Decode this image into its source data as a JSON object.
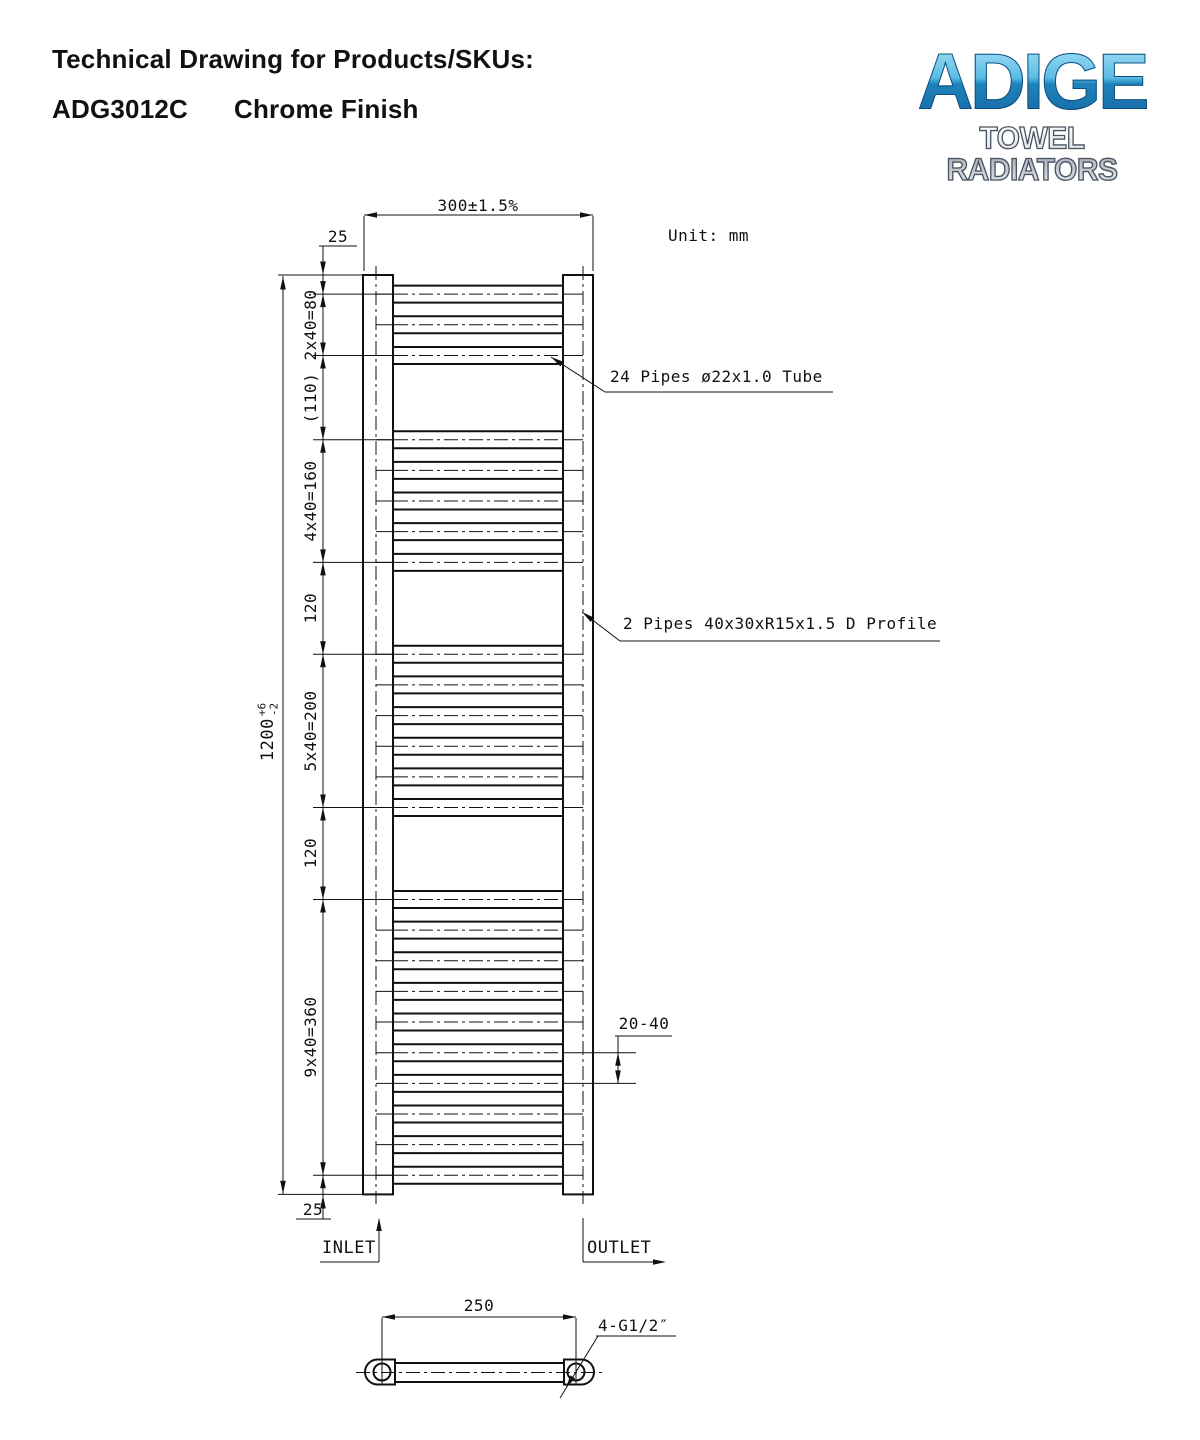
{
  "header": {
    "title": "Technical Drawing for Products/SKUs:",
    "sku": "ADG3012C",
    "finish": "Chrome Finish"
  },
  "logo": {
    "brand": "ADIGE",
    "tagline": "TOWEL RADIATORS",
    "brand_color_top": "#a6e2f7",
    "brand_color_bottom": "#1467a3"
  },
  "drawing": {
    "unit": "Unit: mm",
    "line_color": "#111111"
  },
  "dims": {
    "width": "300±1.5%",
    "top_offset": "25",
    "bottom_offset": "25",
    "overall": {
      "base": "1200",
      "plus": "+6",
      "minus": "-2"
    },
    "bracket": "20-40",
    "centers": "250",
    "thread": "4-G1/2″"
  },
  "notes": {
    "pipes": "24 Pipes ø22x1.0 Tube",
    "profile": "2 Pipes 40x30xR15x1.5 D Profile"
  },
  "ports": {
    "inlet": "INLET",
    "outlet": "OUTLET"
  },
  "radiator": {
    "pipe_count": 24,
    "pipe_centers_mm": [
      25,
      65,
      105,
      215,
      255,
      295,
      335,
      375,
      495,
      535,
      575,
      615,
      655,
      695,
      815,
      855,
      895,
      935,
      975,
      1015,
      1055,
      1095,
      1135,
      1175
    ],
    "boundaries_mm": [
      25,
      105,
      215,
      375,
      495,
      695,
      815,
      1175
    ],
    "chain_segments": [
      {
        "label": "2x40=80",
        "mid_mm": 65
      },
      {
        "label": "(110)",
        "mid_mm": 160
      },
      {
        "label": "4x40=160",
        "mid_mm": 295
      },
      {
        "label": "120",
        "mid_mm": 435
      },
      {
        "label": "5x40=200",
        "mid_mm": 595
      },
      {
        "label": "120",
        "mid_mm": 755
      },
      {
        "label": "9x40=360",
        "mid_mm": 995
      }
    ],
    "bracket_pipes_mm": [
      1015,
      1055
    ],
    "overall_mm": 1200,
    "width_mm": 300,
    "centers_mm": 250
  }
}
